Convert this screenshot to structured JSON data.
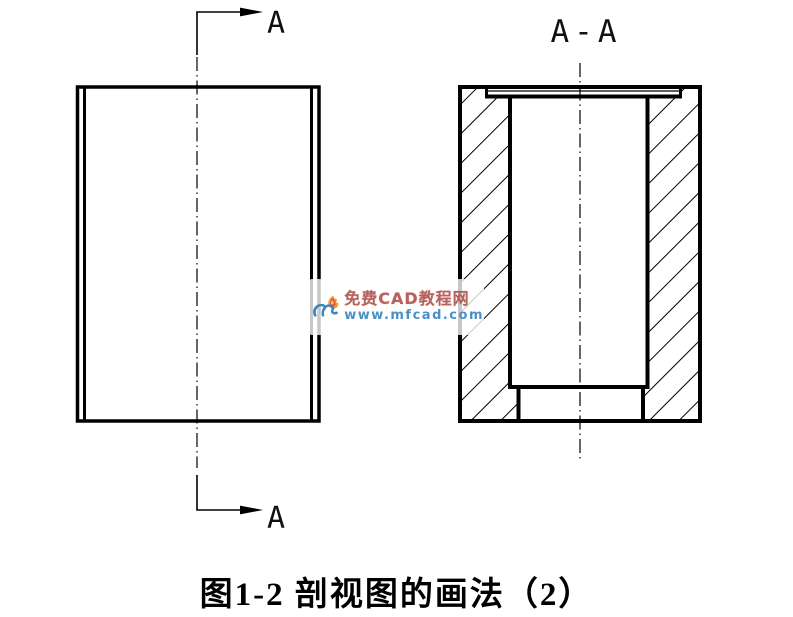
{
  "canvas": {
    "background": "#ffffff",
    "line_color": "#000000"
  },
  "labels": {
    "cutting_arrow_top": "A",
    "cutting_arrow_bottom": "A",
    "section_title": "A-A"
  },
  "watermark": {
    "site_name": "免费CAD教程网",
    "site_url": "www.mfcad.com",
    "brand_blue": "#3c86c0",
    "brand_blue_dark": "#2a6da3",
    "brand_orange": "#f79b33",
    "brand_red": "#e0473a",
    "name_color": "#b2524c",
    "url_color": "#4a90c8"
  },
  "caption": {
    "text": "图1-2 剖视图的画法（2）",
    "color": "#000000"
  }
}
